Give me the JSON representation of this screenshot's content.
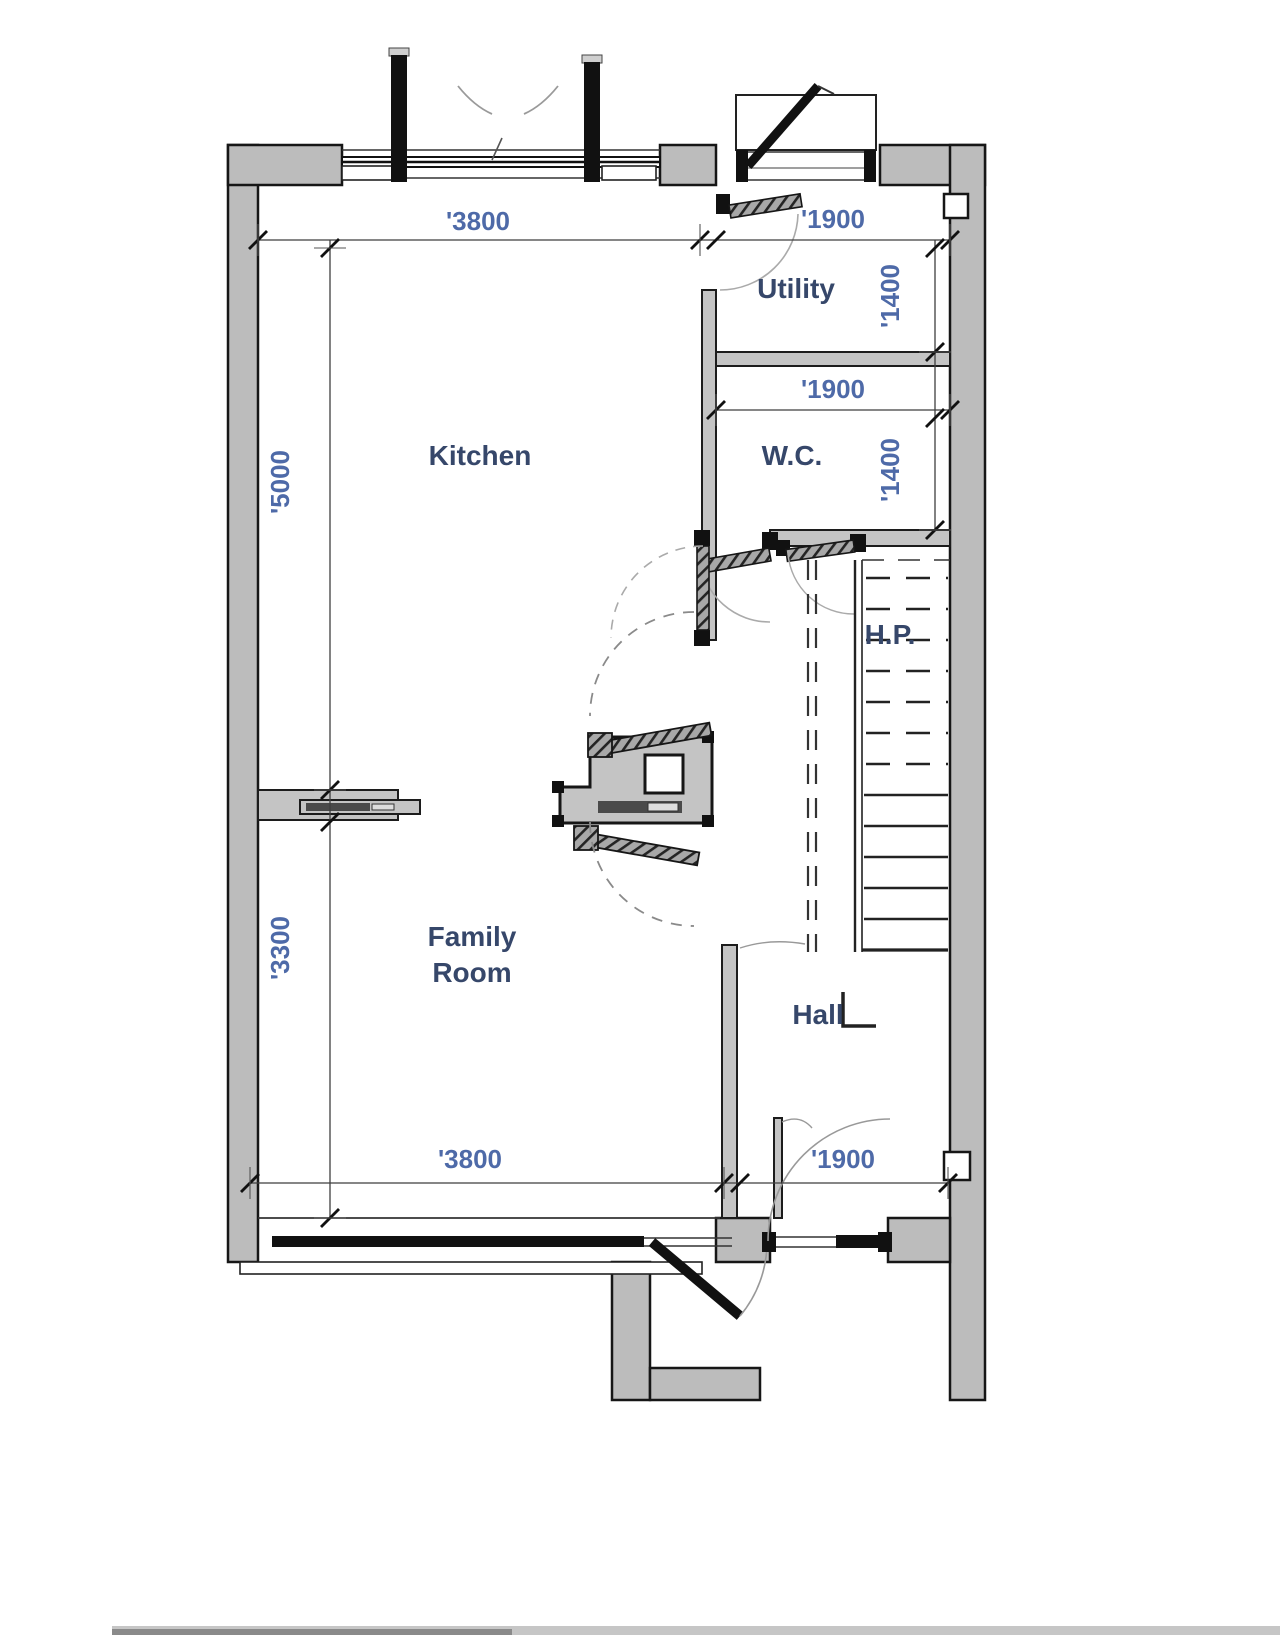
{
  "title": "Ground Floor Plan",
  "colors": {
    "wall_fill": "#bcbcbc",
    "outline": "#161616",
    "thin_line": "#3f3f3f",
    "label": "#36476a",
    "dimension": "#4e6aa8"
  },
  "rooms": {
    "kitchen": {
      "label": "Kitchen"
    },
    "utility": {
      "label": "Utility"
    },
    "wc": {
      "label": "W.C."
    },
    "hp": {
      "label": "H.P."
    },
    "family_room": {
      "label_line1": "Family",
      "label_line2": "Room"
    },
    "hall": {
      "label": "Hall"
    }
  },
  "dimensions": {
    "kitchen_width": "'3800",
    "kitchen_depth": "'5000",
    "utility_width": "'1900",
    "utility_depth": "'1400",
    "wc_width": "'1900",
    "wc_depth": "'1400",
    "family_depth": "'3300",
    "family_width": "'3800",
    "hall_width": "'1900"
  }
}
